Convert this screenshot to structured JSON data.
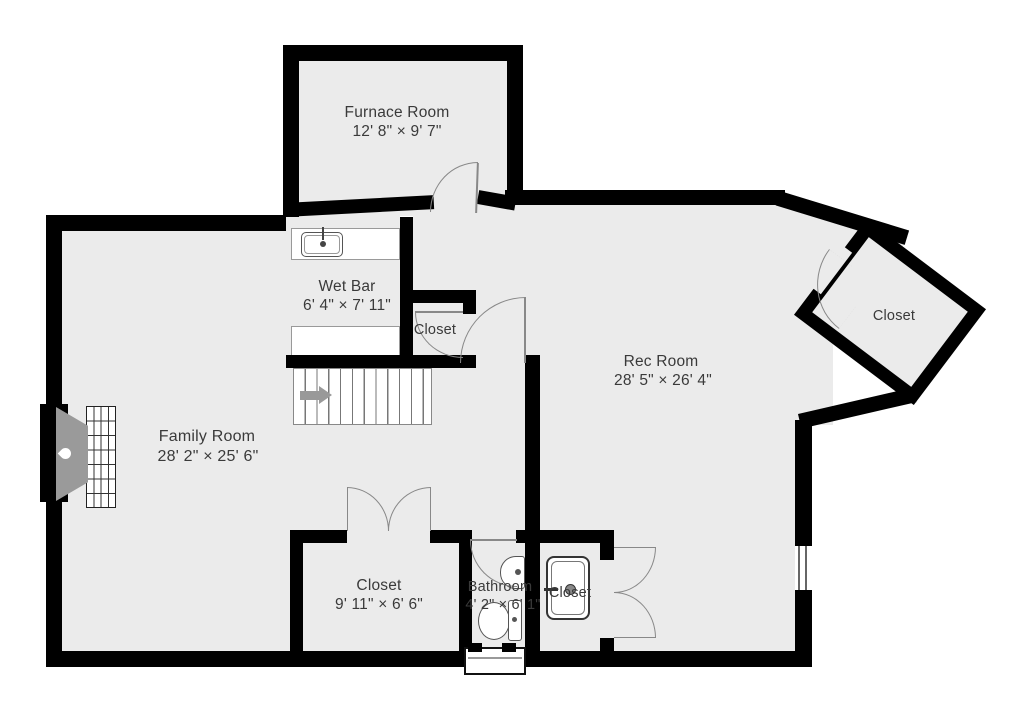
{
  "plan": {
    "type": "basement-floor-plan",
    "rooms": [
      {
        "id": "furnace_room",
        "name": "Furnace Room",
        "dimensions": "12' 8\" × 9' 7\""
      },
      {
        "id": "wet_bar",
        "name": "Wet Bar",
        "dimensions": "6' 4\" × 7' 11\""
      },
      {
        "id": "closet_wetbar",
        "name": "Closet",
        "dimensions": ""
      },
      {
        "id": "rec_room",
        "name": "Rec Room",
        "dimensions": "28' 5\" × 26' 4\""
      },
      {
        "id": "closet_angled",
        "name": "Closet",
        "dimensions": ""
      },
      {
        "id": "family_room",
        "name": "Family Room",
        "dimensions": "28' 2\" × 25' 6\""
      },
      {
        "id": "closet_lower",
        "name": "Closet",
        "dimensions": "9' 11\" × 6' 6\""
      },
      {
        "id": "bathroom",
        "name": "Bathroom",
        "dimensions": "4' 2\" × 6' 1\""
      },
      {
        "id": "closet_utility",
        "name": "Closet",
        "dimensions": ""
      }
    ],
    "fixtures": [
      "fireplace",
      "stairs-up-arrow",
      "wet-bar-sink",
      "bathroom-sink",
      "toilet",
      "utility-sink"
    ],
    "colors": {
      "wall": "#000000",
      "floor": "#ebebeb",
      "background": "#ffffff",
      "fixture_gray": "#9a9a9a",
      "text": "#3a3a3a"
    }
  }
}
